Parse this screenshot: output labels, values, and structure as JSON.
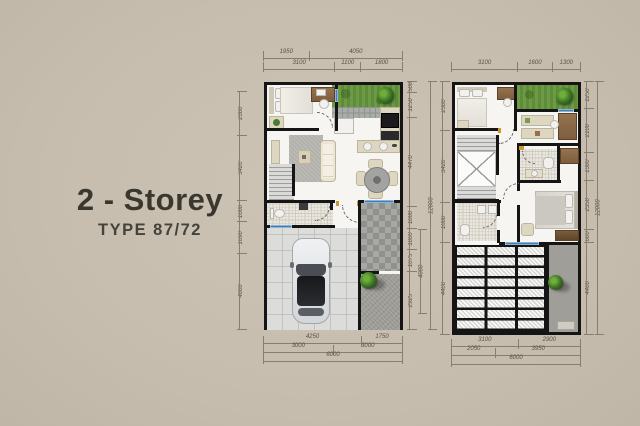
{
  "title": {
    "main": "2 - Storey",
    "sub": "TYPE 87/72"
  },
  "plan1": {
    "label": "first-floor-plan",
    "dims": {
      "top1": [
        "1950",
        "4050"
      ],
      "top2": [
        "3100",
        "1100",
        "1800"
      ],
      "left": [
        "2300",
        "3420",
        "1080",
        "1690",
        "4000"
      ],
      "right_inner": [
        "500",
        "1250",
        "4470",
        "1080",
        "1000",
        "1075",
        "2925"
      ],
      "right_mid": "4000",
      "right_total": "12000",
      "bottom1": [
        "4250",
        "1750"
      ],
      "bottom2": [
        "3000",
        "3000"
      ],
      "bottom_total": "6000"
    }
  },
  "plan2": {
    "label": "second-floor-plan",
    "dims": {
      "top": [
        "3100",
        "1600",
        "1300"
      ],
      "left": [
        "2300",
        "3420",
        "1880",
        "4400"
      ],
      "right_inner": [
        "1250",
        "2100",
        "1300",
        "2350",
        "600",
        "4400"
      ],
      "right_total": "12000",
      "bottom1": [
        "3100",
        "2900"
      ],
      "bottom2": [
        "2050",
        "3950"
      ],
      "bottom_total": "6000"
    }
  },
  "colors": {
    "background": "#c7bdaf",
    "wall": "#151515",
    "floor": "#f6f5f2",
    "grass": "#639040",
    "window_blue": "#3f7fb8",
    "wood": "#846544",
    "title_text": "#3a372f"
  }
}
